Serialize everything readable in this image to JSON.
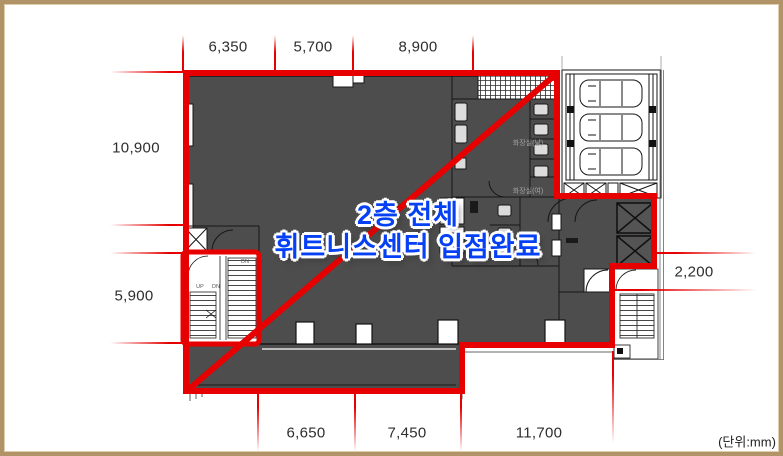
{
  "figure": {
    "type": "floor-plan",
    "unit_note": "(단위:mm)"
  },
  "overlay": {
    "line1": "2층 전체",
    "line2": "휘트니스센터 입점완료"
  },
  "dims": {
    "top": [
      "6,350",
      "5,700",
      "8,900"
    ],
    "left": [
      "10,900",
      "5,900"
    ],
    "right": [
      "2,200"
    ],
    "bottom": [
      "6,650",
      "7,450",
      "11,700"
    ]
  },
  "plan": {
    "toilet_upper": "화장실(남)",
    "toilet_lower": "화장실(여)",
    "stair_up": "UP",
    "stair_dn": "DN"
  },
  "colors": {
    "highlight_red": "#e60000",
    "overlay_blue": "#0540f5",
    "floor_fill": "#4d4d4d",
    "frame_tan": "#b29367"
  }
}
